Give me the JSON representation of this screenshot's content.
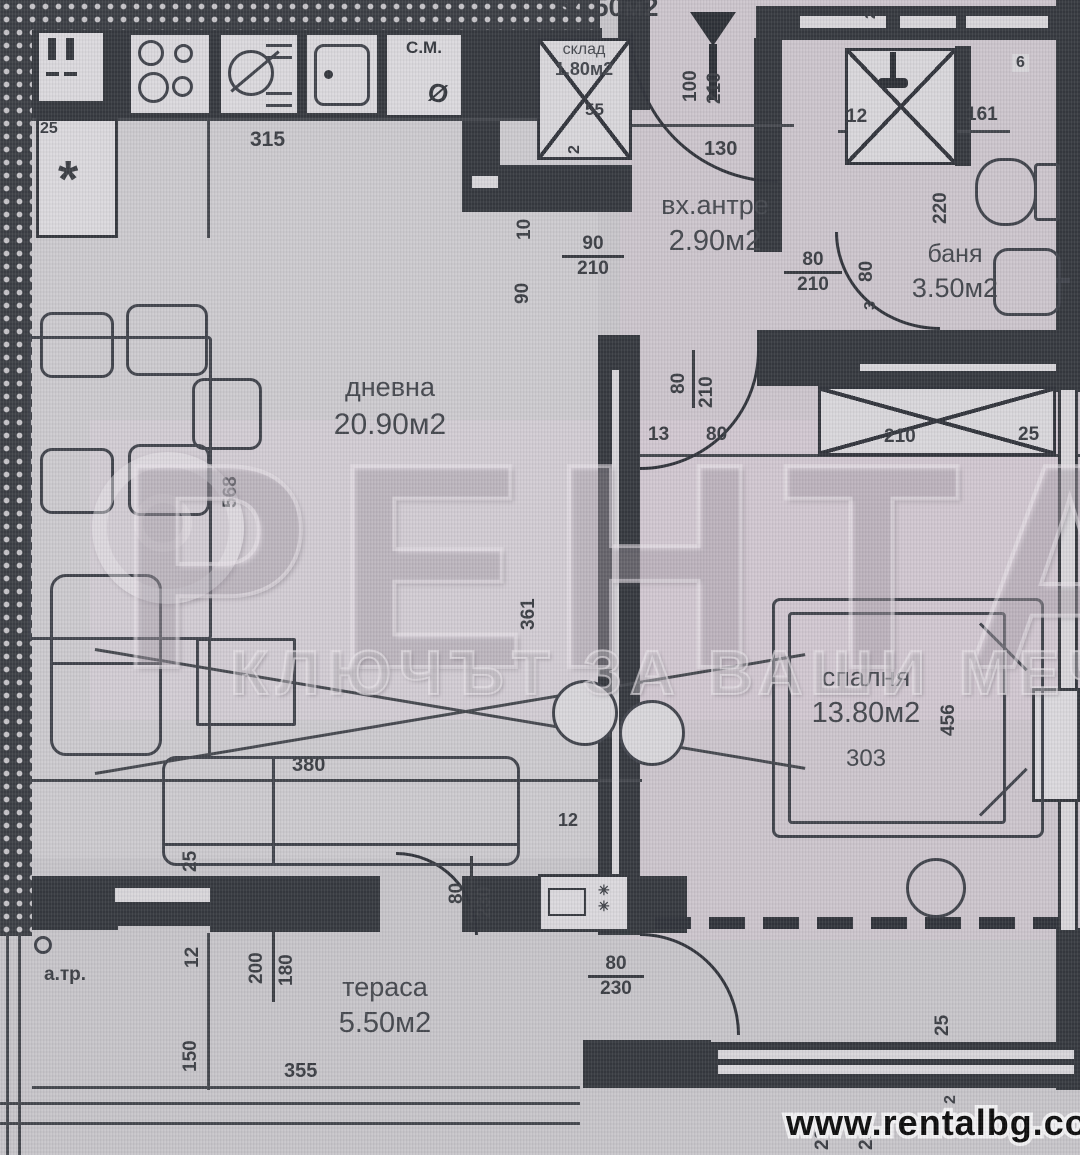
{
  "watermark": {
    "brand": "РЕНТАЛ",
    "slogan": "КЛЮЧЪТ ЗА ВАШИ МЕЧТИ",
    "website": "www.rentalbg.com"
  },
  "plan": {
    "total_area": "54.50м2"
  },
  "rooms": {
    "living": {
      "name": "дневна",
      "area": "20.90м2"
    },
    "entry": {
      "name": "вх.антре",
      "area": "2.90м2"
    },
    "bath": {
      "name": "баня",
      "area": "3.50м2"
    },
    "bedroom": {
      "name": "спалня",
      "area": "13.80м2"
    },
    "terrace": {
      "name": "тераса",
      "area": "5.50м2"
    },
    "storage": {
      "name": "склад",
      "area": "1.80м2"
    }
  },
  "doors": {
    "entrance": {
      "w": "100",
      "h": "210"
    },
    "hall_living": {
      "w": "90",
      "h": "210"
    },
    "bath": {
      "w": "80",
      "h": "210"
    },
    "bedroom": {
      "w": "80",
      "h": "210"
    },
    "living_terrace": {
      "w": "80",
      "h": "230"
    },
    "bedroom_terrace": {
      "w": "80",
      "h": "230"
    }
  },
  "dims": {
    "kitchen_width": "315",
    "kitchen_side": "25",
    "entry_width": "130",
    "storage_depth": "55",
    "storage_side": "2",
    "wall_10": "10",
    "wall_90": "90",
    "shower_side": "12",
    "bath_width": "161",
    "bath_depth": "220",
    "bath_niche": "6",
    "bath_door_w": "80",
    "bath_wall": "3",
    "top_small_2": "2",
    "living_width": "568",
    "living_depth": "361",
    "wall_12": "12",
    "door_gap_13": "13",
    "door_gap_80": "80",
    "wardrobe_width": "210",
    "wardrobe_side": "25",
    "bedroom_width": "303",
    "bedroom_depth": "456",
    "sofa_width": "380",
    "sofa_side": "25",
    "terrace_width": "355",
    "terrace_depth": "150",
    "terrace_side": "12",
    "terrace_window_w": "200",
    "terrace_window_h": "180",
    "bterrace_side": "25",
    "bterrace_w": "200",
    "bterrace_d": "230",
    "bterrace_2": "2"
  },
  "symbols": {
    "washing_machine": "С.М.",
    "diameter": "Ø",
    "asterisk": "*",
    "shaft_mark": "✳",
    "drain_label": "а.тр."
  }
}
